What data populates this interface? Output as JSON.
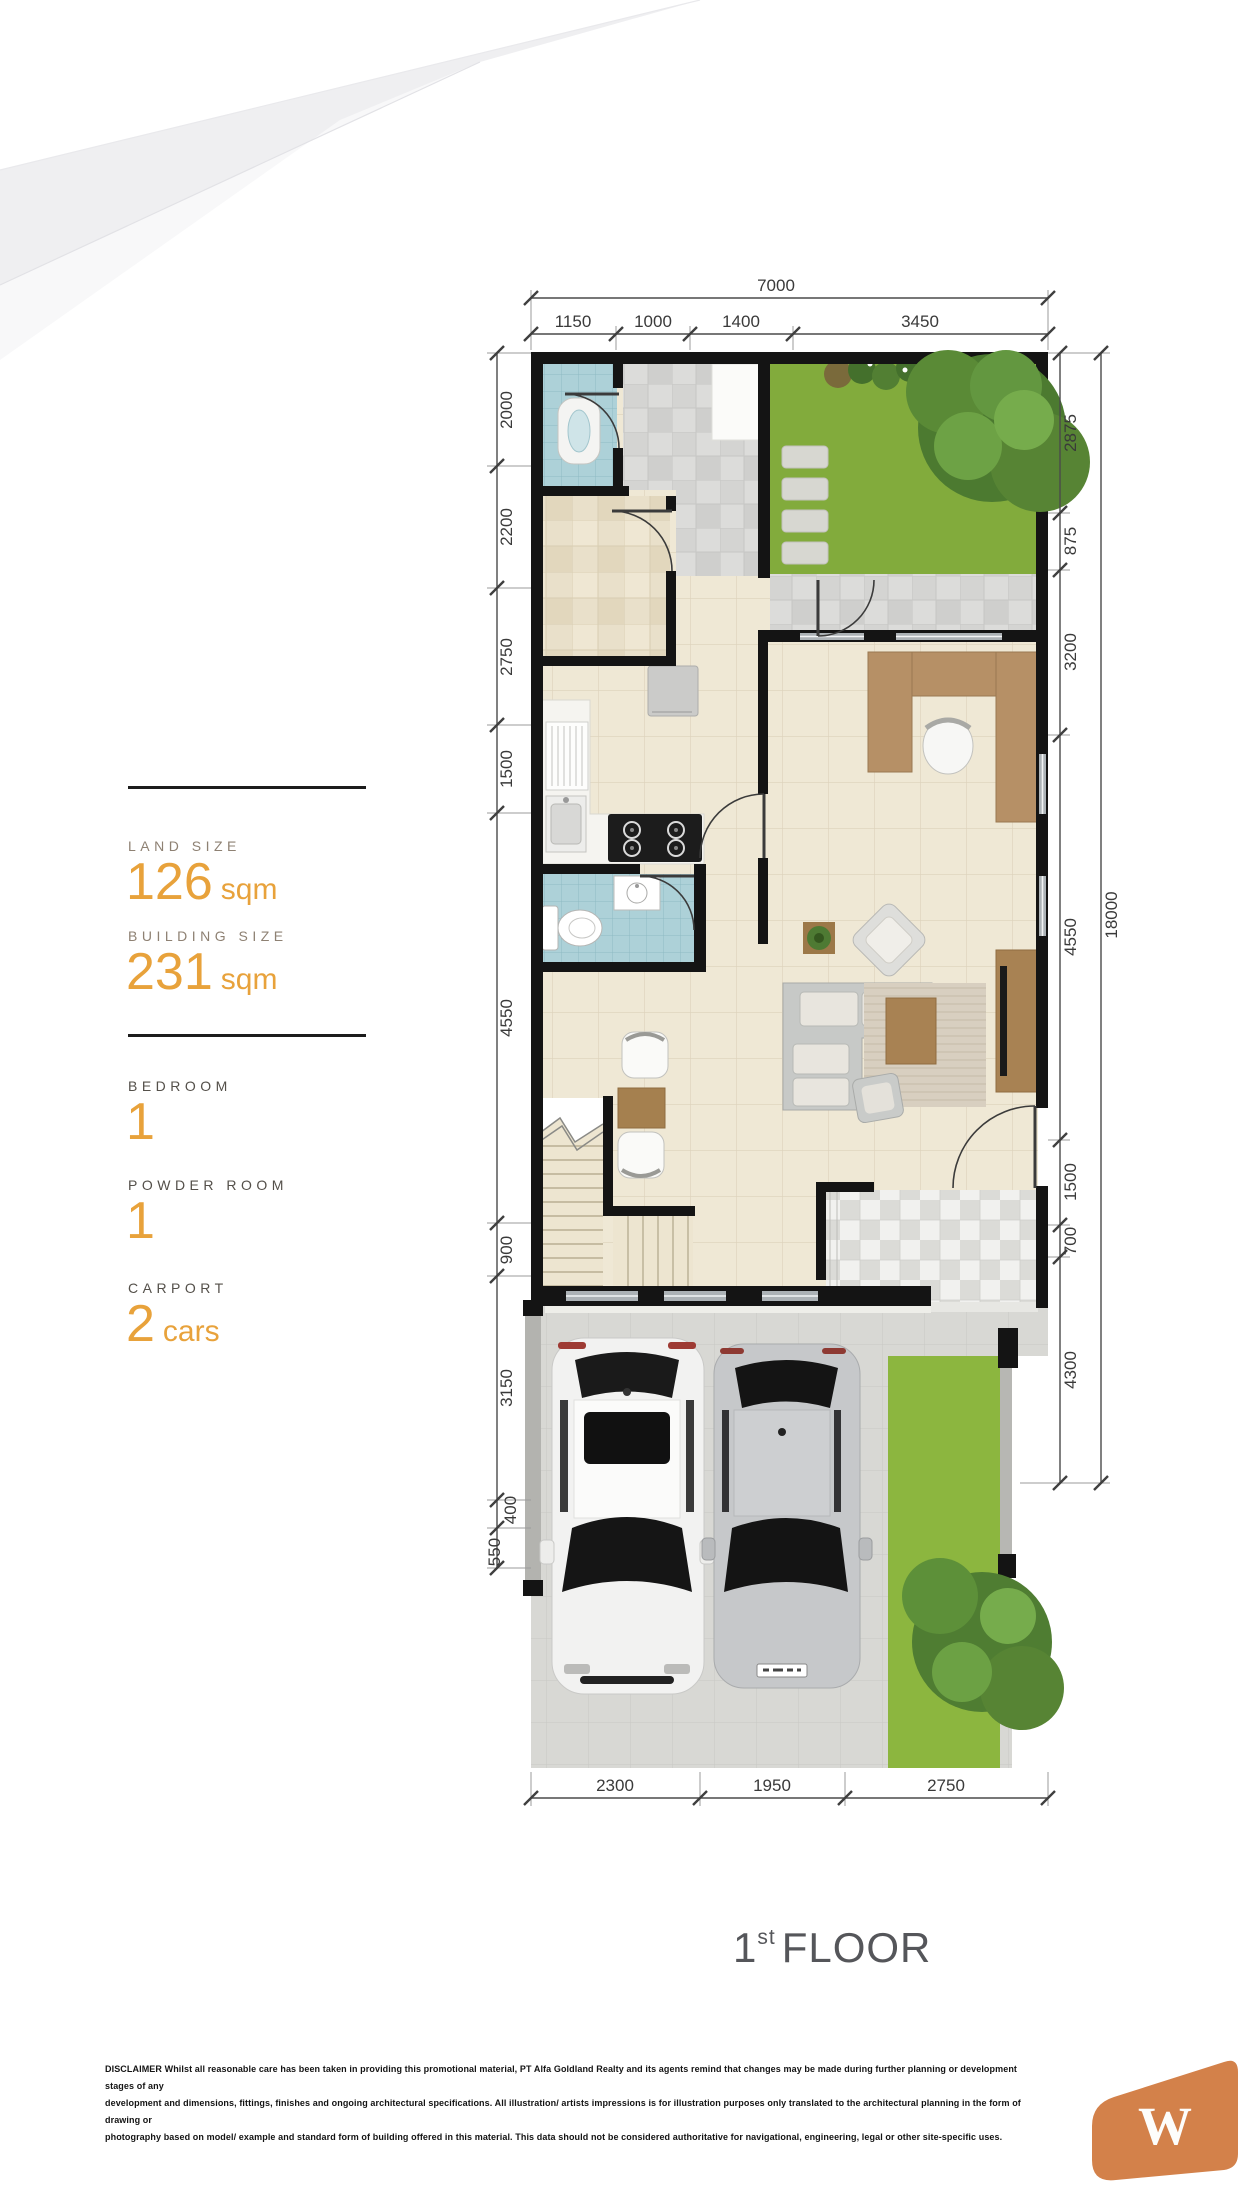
{
  "specs": {
    "items": [
      {
        "label": "LAND SIZE",
        "value": "126",
        "unit": "sqm"
      },
      {
        "label": "BUILDING SIZE",
        "value": "231",
        "unit": "sqm"
      },
      {
        "label": "BEDROOM",
        "value": "1",
        "unit": ""
      },
      {
        "label": "POWDER ROOM",
        "value": "1",
        "unit": ""
      },
      {
        "label": "CARPORT",
        "value": "2",
        "unit": "cars"
      }
    ]
  },
  "floor_title": {
    "number": "1",
    "ordinal": "st",
    "word": "FLOOR"
  },
  "dimensions": {
    "overall_width": "7000",
    "overall_height": "18000",
    "top": [
      "1150",
      "1000",
      "1400",
      "3450"
    ],
    "left": [
      "2000",
      "2200",
      "2750",
      "1500",
      "4550",
      "900",
      "3150",
      "400",
      "550"
    ],
    "right": [
      "2875",
      "875",
      "3200",
      "4550",
      "1500",
      "700",
      "4300"
    ],
    "bottom": [
      "2300",
      "1950",
      "2750"
    ]
  },
  "disclaimer": {
    "lines": [
      "DISCLAIMER Whilst all reasonable care has been taken in providing this promotional material, PT Alfa Goldland Realty and its agents remind that changes may be made during further planning or development stages of any",
      "development and dimensions, fittings, finishes and ongoing architectural specifications. All illustration/ artists impressions is for illustration purposes only translated to the architectural planning in the form of drawing or",
      "photography based on model/ example and standard form of building offered in this material. This data should not be considered authoritative for navigational, engineering, legal or other site-specific uses."
    ]
  },
  "logo": {
    "letter": "W"
  },
  "colors": {
    "accent_orange": "#E8A23B",
    "logo_orange": "#D3814A",
    "wall_black": "#141414",
    "grass_green": "#82AB3C",
    "teal_tile": "#ADD1D8",
    "title_gray": "#55565A"
  }
}
